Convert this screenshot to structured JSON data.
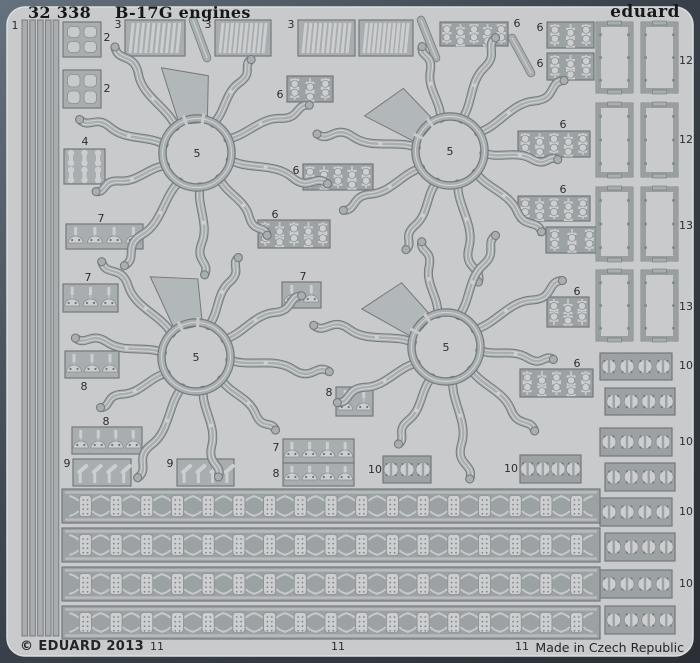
{
  "title": {
    "catalog_number": "32 338",
    "product_name": "B-17G engines"
  },
  "brand": "eduard",
  "footer": {
    "copyright": "© EDUARD 2013",
    "made_in": "Made in Czech Republic"
  },
  "colors": {
    "board_light": "#5f6d79",
    "board_dark": "#2c3138",
    "fret": "#c8cacb",
    "fret_edge": "#dcdedf",
    "plate": "#a8adb0",
    "plate_dark": "#9ca1a4",
    "unit": "#ccced0",
    "unit_bright": "#dcdedf",
    "outline": "#76797c",
    "unit_outline": "#8c9093",
    "web": "#b2b7ba",
    "label": "#2b2d2f"
  },
  "parts": [
    {
      "t": "strips",
      "x": 22,
      "y": 20,
      "w": 38,
      "h": 616,
      "lab": "1",
      "lx": 15,
      "ly": 29
    },
    {
      "t": "clover",
      "x": 63,
      "y": 22,
      "w": 38,
      "h": 35,
      "lab": "2",
      "lx": 107,
      "ly": 41
    },
    {
      "t": "clover",
      "x": 63,
      "y": 70,
      "w": 38,
      "h": 38,
      "lab": "2",
      "lx": 107,
      "ly": 92
    },
    {
      "t": "comb",
      "x": 125,
      "y": 20,
      "w": 60,
      "h": 36,
      "lab": "3",
      "lx": 118,
      "ly": 28
    },
    {
      "t": "comb",
      "x": 215,
      "y": 20,
      "w": 56,
      "h": 36,
      "lab": "3",
      "lx": 208,
      "ly": 28
    },
    {
      "t": "comb",
      "x": 298,
      "y": 20,
      "w": 57,
      "h": 36,
      "lab": "3",
      "lx": 291,
      "ly": 28
    },
    {
      "t": "comb",
      "x": 359,
      "y": 20,
      "w": 54,
      "h": 36,
      "lab": null
    },
    {
      "t": "diag",
      "x1": 193,
      "y1": 20,
      "x2": 207,
      "y2": 58
    },
    {
      "t": "diag",
      "x1": 421,
      "y1": 20,
      "x2": 436,
      "y2": 58
    },
    {
      "t": "diag",
      "x1": 512,
      "y1": 38,
      "x2": 531,
      "y2": 73
    },
    {
      "t": "slots",
      "x": 64,
      "y": 149,
      "w": 41,
      "h": 35,
      "lab": "4",
      "lx": 85,
      "ly": 145
    },
    {
      "t": "spools",
      "x": 440,
      "y": 22,
      "w": 68,
      "h": 24,
      "n": 5,
      "lab": "6",
      "lx": 517,
      "ly": 27
    },
    {
      "t": "spools",
      "x": 547,
      "y": 22,
      "w": 47,
      "h": 26,
      "n": 3,
      "lab": "6",
      "lx": 540,
      "ly": 31
    },
    {
      "t": "spools",
      "x": 547,
      "y": 53,
      "w": 47,
      "h": 27,
      "n": 3,
      "lab": "6",
      "lx": 540,
      "ly": 67
    },
    {
      "t": "spools",
      "x": 287,
      "y": 76,
      "w": 46,
      "h": 26,
      "n": 3,
      "lab": "6",
      "lx": 280,
      "ly": 98
    },
    {
      "t": "spools",
      "x": 518,
      "y": 131,
      "w": 72,
      "h": 26,
      "n": 5,
      "lab": "6",
      "lx": 563,
      "ly": 128
    },
    {
      "t": "spools",
      "x": 303,
      "y": 164,
      "w": 70,
      "h": 26,
      "n": 5,
      "lab": "6",
      "lx": 296,
      "ly": 174
    },
    {
      "t": "spools",
      "x": 518,
      "y": 196,
      "w": 72,
      "h": 25,
      "n": 5,
      "lab": "6",
      "lx": 563,
      "ly": 193
    },
    {
      "t": "spools",
      "x": 258,
      "y": 220,
      "w": 72,
      "h": 28,
      "n": 5,
      "lab": "6",
      "lx": 275,
      "ly": 218
    },
    {
      "t": "spools",
      "x": 546,
      "y": 227,
      "w": 52,
      "h": 26,
      "n": 3,
      "lab": "6",
      "lx": 540,
      "ly": 236
    },
    {
      "t": "spools",
      "x": 547,
      "y": 297,
      "w": 42,
      "h": 30,
      "n": 3,
      "lab": "6",
      "lx": 577,
      "ly": 295
    },
    {
      "t": "spools",
      "x": 520,
      "y": 369,
      "w": 73,
      "h": 28,
      "n": 5,
      "lab": "6",
      "lx": 577,
      "ly": 367
    },
    {
      "t": "domes",
      "x": 66,
      "y": 224,
      "w": 77,
      "h": 25,
      "n": 4,
      "lab": "7",
      "lx": 101,
      "ly": 222
    },
    {
      "t": "domes",
      "x": 63,
      "y": 284,
      "w": 55,
      "h": 28,
      "n": 3,
      "lab": "7",
      "lx": 88,
      "ly": 281
    },
    {
      "t": "domes",
      "x": 282,
      "y": 282,
      "w": 39,
      "h": 26,
      "n": 2,
      "lab": "7",
      "lx": 303,
      "ly": 280
    },
    {
      "t": "domes",
      "x": 65,
      "y": 351,
      "w": 54,
      "h": 27,
      "n": 3,
      "lab": "8",
      "lx": 84,
      "ly": 390
    },
    {
      "t": "domes",
      "x": 72,
      "y": 427,
      "w": 70,
      "h": 27,
      "n": 4,
      "lab": "8",
      "lx": 106,
      "ly": 425
    },
    {
      "t": "domes",
      "x": 336,
      "y": 387,
      "w": 37,
      "h": 29,
      "n": 2,
      "lab": "8",
      "lx": 329,
      "ly": 396
    },
    {
      "t": "domes",
      "x": 283,
      "y": 439,
      "w": 71,
      "h": 24,
      "n": 4,
      "lab": "7",
      "lx": 276,
      "ly": 451
    },
    {
      "t": "domes",
      "x": 283,
      "y": 463,
      "w": 71,
      "h": 23,
      "n": 4,
      "lab": "8",
      "lx": 276,
      "ly": 477
    },
    {
      "t": "sticks",
      "x": 73,
      "y": 459,
      "w": 58,
      "h": 27,
      "n": 4,
      "lab": "9",
      "lx": 67,
      "ly": 467
    },
    {
      "t": "sticks",
      "x": 177,
      "y": 459,
      "w": 57,
      "h": 27,
      "n": 4,
      "lab": "9",
      "lx": 170,
      "ly": 467
    },
    {
      "t": "clips",
      "x": 383,
      "y": 456,
      "w": 48,
      "h": 27,
      "n": 3,
      "lab": "10",
      "lx": 375,
      "ly": 473
    },
    {
      "t": "clips",
      "x": 520,
      "y": 455,
      "w": 61,
      "h": 28,
      "n": 4,
      "lab": "10",
      "lx": 511,
      "ly": 472
    },
    {
      "t": "clips",
      "x": 600,
      "y": 353,
      "w": 72,
      "h": 27,
      "n": 4,
      "lab": "10",
      "lx": 686,
      "ly": 369
    },
    {
      "t": "clips",
      "x": 605,
      "y": 388,
      "w": 70,
      "h": 27,
      "n": 4,
      "lab": null
    },
    {
      "t": "clips",
      "x": 600,
      "y": 428,
      "w": 72,
      "h": 28,
      "n": 4,
      "lab": "10",
      "lx": 686,
      "ly": 445
    },
    {
      "t": "clips",
      "x": 605,
      "y": 463,
      "w": 70,
      "h": 28,
      "n": 4,
      "lab": null
    },
    {
      "t": "clips",
      "x": 600,
      "y": 498,
      "w": 72,
      "h": 28,
      "n": 4,
      "lab": "10",
      "lx": 686,
      "ly": 515
    },
    {
      "t": "clips",
      "x": 605,
      "y": 533,
      "w": 70,
      "h": 28,
      "n": 4,
      "lab": null
    },
    {
      "t": "clips",
      "x": 600,
      "y": 570,
      "w": 72,
      "h": 28,
      "n": 4,
      "lab": "10",
      "lx": 686,
      "ly": 587
    },
    {
      "t": "clips",
      "x": 605,
      "y": 606,
      "w": 70,
      "h": 28,
      "n": 4,
      "lab": null
    },
    {
      "t": "band",
      "x": 62,
      "y": 489,
      "w": 538,
      "h": 34,
      "lab": null
    },
    {
      "t": "band",
      "x": 62,
      "y": 528,
      "w": 538,
      "h": 34,
      "lab": null
    },
    {
      "t": "band",
      "x": 62,
      "y": 567,
      "w": 538,
      "h": 34,
      "lab": null
    },
    {
      "t": "band",
      "x": 62,
      "y": 606,
      "w": 538,
      "h": 33,
      "lab": null
    },
    {
      "t": "frame",
      "x": 596,
      "y": 22,
      "w": 82,
      "h": 71,
      "lab": "12",
      "lx": 686,
      "ly": 64
    },
    {
      "t": "frame",
      "x": 596,
      "y": 103,
      "w": 82,
      "h": 74,
      "lab": "12",
      "lx": 686,
      "ly": 143
    },
    {
      "t": "frame",
      "x": 596,
      "y": 187,
      "w": 82,
      "h": 74,
      "lab": "13",
      "lx": 686,
      "ly": 229
    },
    {
      "t": "frame",
      "x": 596,
      "y": 270,
      "w": 82,
      "h": 71,
      "lab": "13",
      "lx": 686,
      "ly": 310
    }
  ],
  "spiders": [
    {
      "cx": 197,
      "cy": 153,
      "lab": "5",
      "web": -5
    },
    {
      "cx": 450,
      "cy": 151,
      "lab": "5",
      "web": -50
    },
    {
      "cx": 196,
      "cy": 357,
      "lab": "5",
      "web": -12
    },
    {
      "cx": 446,
      "cy": 347,
      "lab": "5",
      "web": -48
    }
  ],
  "free_labels": [
    {
      "text": "11",
      "x": 157,
      "y": 650
    },
    {
      "text": "11",
      "x": 338,
      "y": 650
    },
    {
      "text": "11",
      "x": 522,
      "y": 650
    }
  ]
}
